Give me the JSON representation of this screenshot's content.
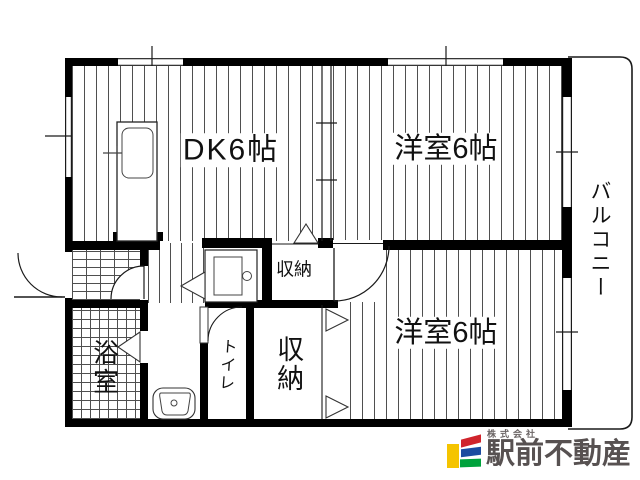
{
  "floorplan": {
    "rooms": [
      {
        "id": "dk",
        "label": "DK6帖"
      },
      {
        "id": "bedroom1",
        "label": "洋室6帖"
      },
      {
        "id": "bedroom2",
        "label": "洋室6帖"
      },
      {
        "id": "balcony",
        "label": "バルコニー"
      },
      {
        "id": "bathroom",
        "label": "浴室"
      },
      {
        "id": "toilet",
        "label": "トイレ"
      },
      {
        "id": "storage_small",
        "label": "収納"
      },
      {
        "id": "storage_large",
        "label": "収納"
      }
    ]
  },
  "branding": {
    "company_prefix": "株式会社",
    "company_name": "駅前不動産",
    "colors": {
      "mark_yellow": "#f5c400",
      "mark_red": "#d0242c",
      "mark_blue": "#1c4ba0",
      "mark_green": "#00a23c",
      "name_text": "#575151"
    }
  }
}
